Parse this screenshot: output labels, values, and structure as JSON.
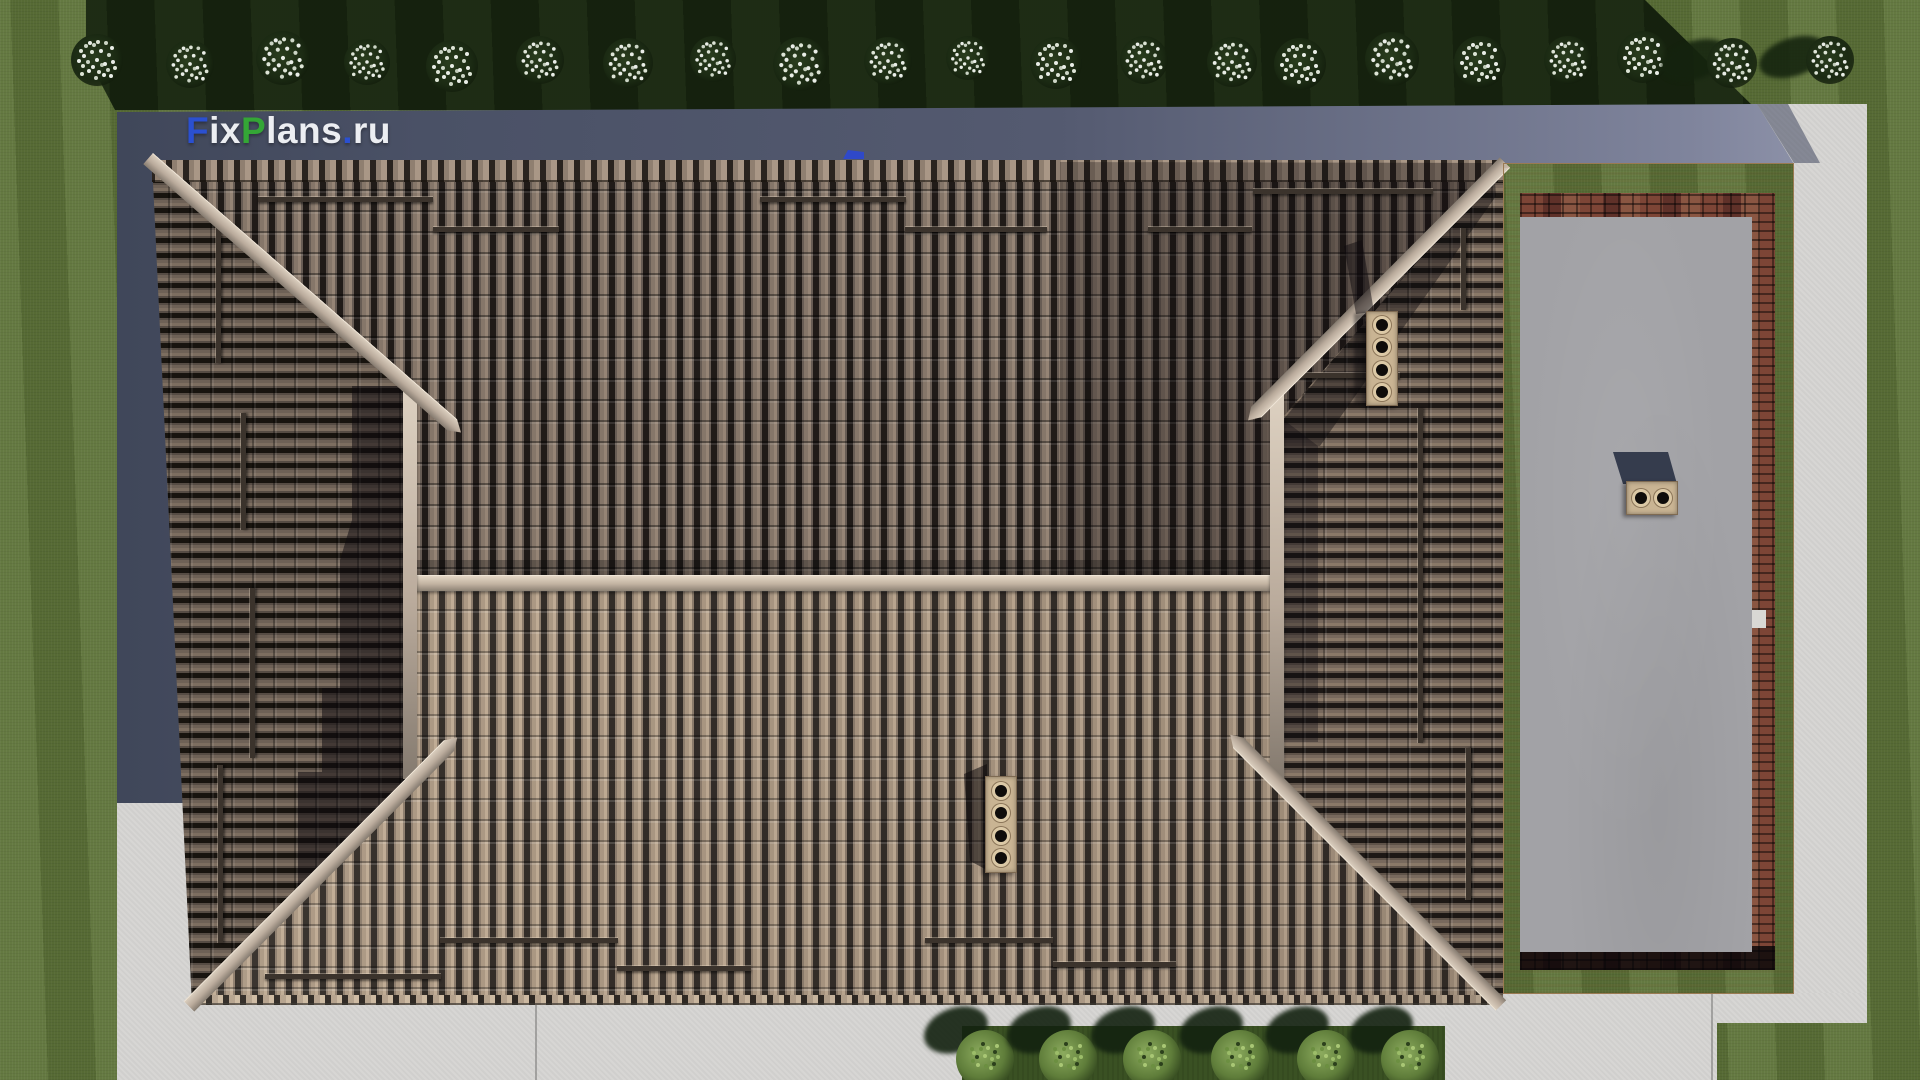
{
  "watermark": {
    "full_text": "FixPlans.ru",
    "segments": [
      {
        "text": "F",
        "color": "#2b50d0"
      },
      {
        "text": "ix",
        "color": "#eceef2"
      },
      {
        "text": "P",
        "color": "#34a636"
      },
      {
        "text": "lans",
        "color": "#eceef2"
      },
      {
        "text": ".",
        "color": "#2b50d0"
      },
      {
        "text": "ru",
        "color": "#eceef2"
      }
    ]
  },
  "scene": {
    "description": "Top-down 3D render of a hipped tile roof with terrace deck, concrete apron, lawn, flowering trees and bushes",
    "palette": {
      "grass": "#5c7138",
      "grass_shadowed": "#17250f",
      "building_shadow": "#4a5166",
      "concrete": "#d7d6d4",
      "roof_north_slope": "#6e625a",
      "roof_south_slope": "#9c8a7a",
      "roof_hip_face": "#5f5650",
      "ridge_cap": "#cfc2b2",
      "terrace_floor": "#a2a2a6",
      "terrace_wood": "#d8b489",
      "terrace_brick": "#7a4335",
      "chimney_base": "#c9b493",
      "tree_blossom": "#e9ede7",
      "bush_foliage": "#7c9a4e"
    },
    "trees": [
      {
        "x": 97,
        "y": 60,
        "d": 52
      },
      {
        "x": 190,
        "y": 64,
        "d": 48
      },
      {
        "x": 283,
        "y": 58,
        "d": 54
      },
      {
        "x": 367,
        "y": 62,
        "d": 46
      },
      {
        "x": 452,
        "y": 66,
        "d": 52
      },
      {
        "x": 540,
        "y": 60,
        "d": 48
      },
      {
        "x": 628,
        "y": 63,
        "d": 50
      },
      {
        "x": 713,
        "y": 59,
        "d": 46
      },
      {
        "x": 800,
        "y": 64,
        "d": 54
      },
      {
        "x": 888,
        "y": 61,
        "d": 48
      },
      {
        "x": 968,
        "y": 58,
        "d": 44
      },
      {
        "x": 1056,
        "y": 63,
        "d": 52
      },
      {
        "x": 1144,
        "y": 60,
        "d": 48
      },
      {
        "x": 1232,
        "y": 62,
        "d": 50
      },
      {
        "x": 1300,
        "y": 64,
        "d": 52
      },
      {
        "x": 1392,
        "y": 59,
        "d": 54
      },
      {
        "x": 1480,
        "y": 62,
        "d": 52
      },
      {
        "x": 1568,
        "y": 60,
        "d": 48
      },
      {
        "x": 1643,
        "y": 57,
        "d": 52
      },
      {
        "x": 1732,
        "y": 63,
        "d": 50,
        "shadow": true
      },
      {
        "x": 1830,
        "y": 60,
        "d": 48,
        "shadow": true
      }
    ],
    "bushes": [
      {
        "x": 985
      },
      {
        "x": 1068
      },
      {
        "x": 1152
      },
      {
        "x": 1240
      },
      {
        "x": 1326
      },
      {
        "x": 1410
      }
    ],
    "snow_guards": [
      {
        "x": 258,
        "y": 197,
        "l": 175
      },
      {
        "x": 433,
        "y": 227,
        "l": 126
      },
      {
        "x": 760,
        "y": 197,
        "l": 146
      },
      {
        "x": 905,
        "y": 227,
        "l": 142
      },
      {
        "x": 1253,
        "y": 189,
        "l": 180
      },
      {
        "x": 1148,
        "y": 227,
        "l": 104
      },
      {
        "x": 440,
        "y": 938,
        "l": 178
      },
      {
        "x": 265,
        "y": 974,
        "l": 176
      },
      {
        "x": 617,
        "y": 966,
        "l": 134
      },
      {
        "x": 925,
        "y": 938,
        "l": 128
      },
      {
        "x": 1053,
        "y": 962,
        "l": 123
      },
      {
        "x": 1287,
        "y": 373,
        "l": 113
      },
      {
        "x": 216,
        "y": 223,
        "l": 140,
        "v": true
      },
      {
        "x": 241,
        "y": 413,
        "l": 117,
        "v": true
      },
      {
        "x": 250,
        "y": 588,
        "l": 170,
        "v": true
      },
      {
        "x": 218,
        "y": 765,
        "l": 178,
        "v": true
      },
      {
        "x": 1461,
        "y": 228,
        "l": 82,
        "v": true
      },
      {
        "x": 1418,
        "y": 408,
        "l": 335,
        "v": true
      },
      {
        "x": 1466,
        "y": 748,
        "l": 152,
        "v": true
      }
    ],
    "chimneys": [
      {
        "name": "north-slope-chimney",
        "x": 1366,
        "y": 311,
        "w": 32,
        "h": 95,
        "flues": 4,
        "dir": "col"
      },
      {
        "name": "south-slope-chimney",
        "x": 985,
        "y": 776,
        "w": 32,
        "h": 97,
        "flues": 4,
        "dir": "col"
      },
      {
        "name": "terrace-chimney",
        "x": 1626,
        "y": 481,
        "w": 52,
        "h": 34,
        "flues": 2,
        "dir": "row"
      }
    ]
  }
}
